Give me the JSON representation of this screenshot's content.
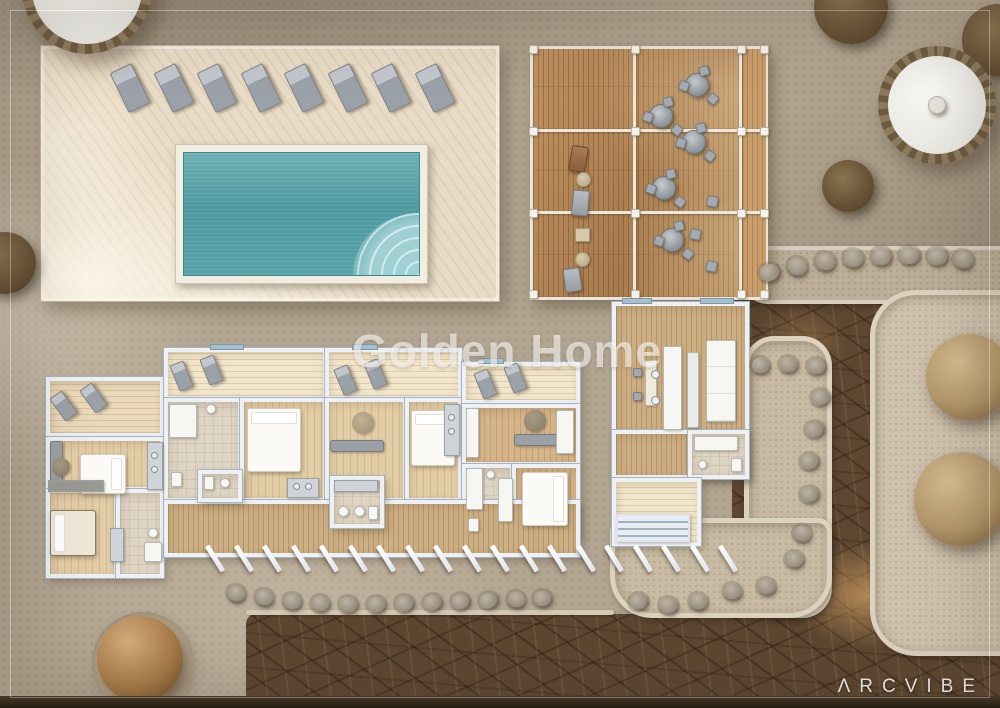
{
  "watermark": {
    "text": "Golden Home"
  },
  "brand": {
    "wordmark": "ΛRCVIBE"
  },
  "scene": {
    "pool_terrace": {
      "sun_loungers": 8
    },
    "dining_deck": {
      "round_tables": 5,
      "lounge_chairs": 3
    },
    "apartment_block": {
      "units": 4,
      "balcony_loungers": 8,
      "beds": 4
    },
    "landscape": {
      "round_trees": 2,
      "shrubs": 4,
      "boulders": 34,
      "parasols": 2
    }
  },
  "palette": {
    "ground": "#b1a490",
    "terrace": "#e9dcc6",
    "pool_water": "#579fa6",
    "deck_wood": "#b5895a",
    "floor_wood": "#e3cda6",
    "wall_white": "#edf1f5",
    "paving_dark": "#5d4731",
    "gravel": "#c8baa3",
    "tree_brown": "#a87c48",
    "stone_gray": "#978e80",
    "text_white": "#f2efe8"
  }
}
